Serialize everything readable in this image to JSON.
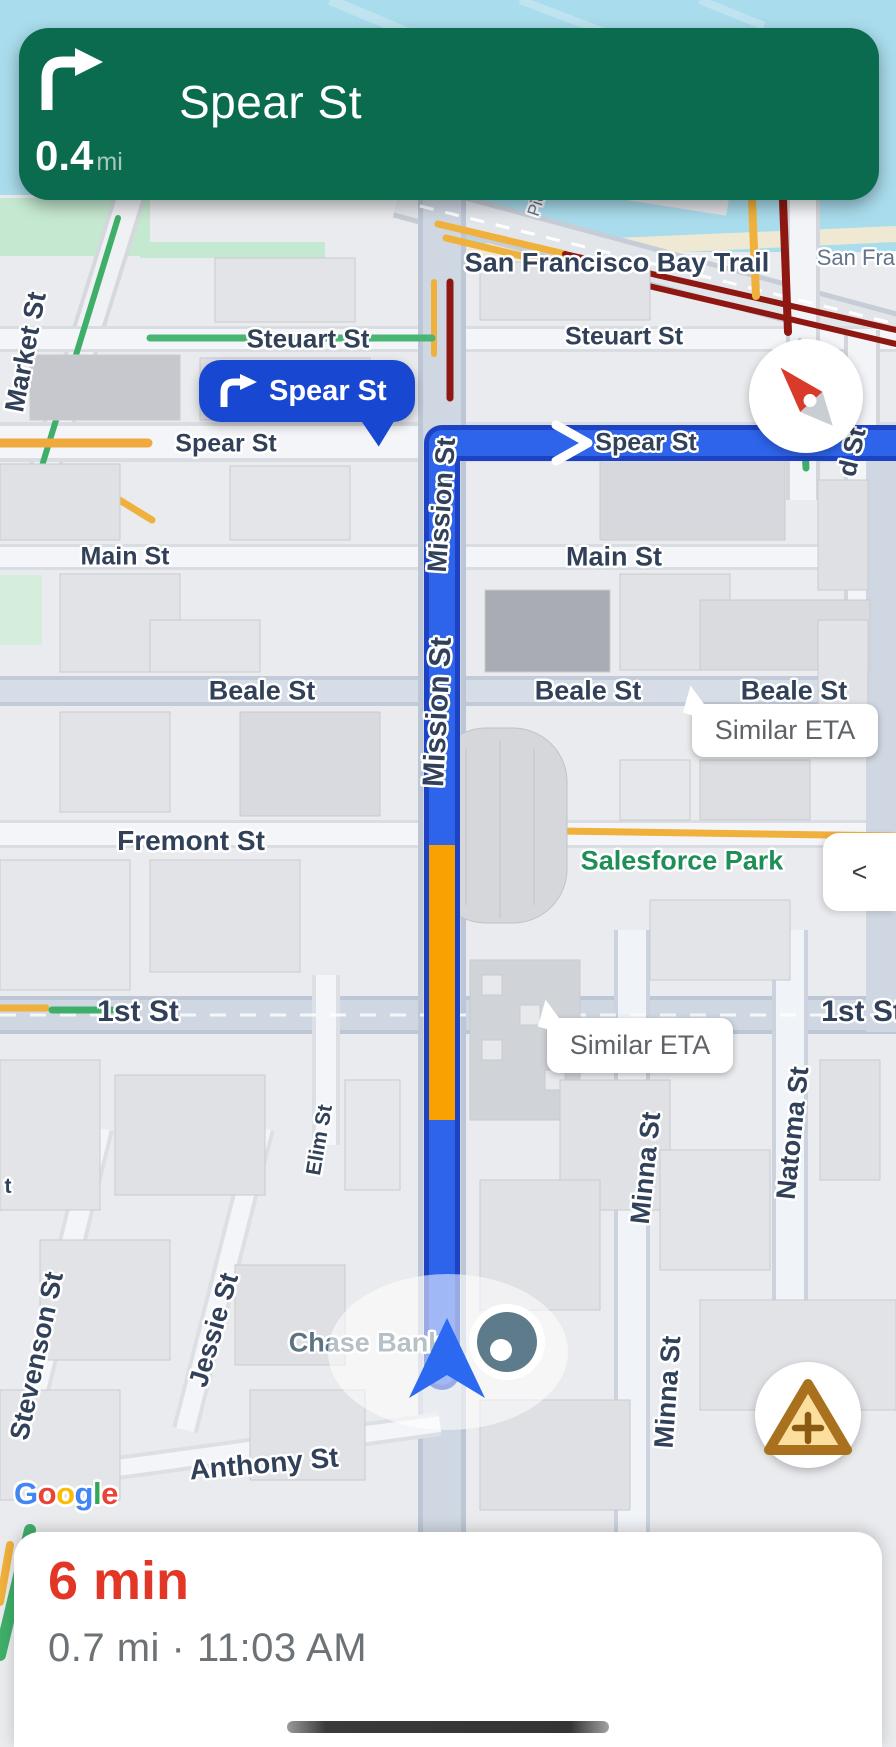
{
  "app": "maps-navigation",
  "navigation_banner": {
    "maneuver_icon": "turn-right-arrow",
    "distance": "0.4",
    "distance_unit": "mi",
    "instruction": "Spear St"
  },
  "turn_callout": {
    "icon": "turn-right-arrow",
    "label": "Spear St"
  },
  "route": {
    "current_street": "Mission St",
    "next_street": "Spear St"
  },
  "eta_bubbles": [
    {
      "text": "Similar ETA"
    },
    {
      "text": "Similar ETA"
    }
  ],
  "map_controls": {
    "compass_icon": "compass-needle",
    "collapse_label": "<",
    "report_icon": "warning-triangle-plus"
  },
  "map_labels": {
    "bay_trail": "San Francisco Bay Trail",
    "san_fran_partial": "San Fran",
    "pier_partial": "Pie",
    "steuart_left": "Steuart St",
    "steuart_right": "Steuart St",
    "spear_left": "Spear St",
    "spear_right": "Spear St",
    "market": "Market St",
    "main_left": "Main St",
    "main_right": "Main St",
    "beale_left": "Beale St",
    "beale_center": "Beale St",
    "beale_right": "Beale St",
    "fremont": "Fremont St",
    "salesforce_park": "Salesforce Park",
    "first_left": "1st St",
    "first_right": "1st St",
    "second_partial": "d St",
    "natoma": "Natoma St",
    "minna_upper": "Minna St",
    "minna_lower": "Minna St",
    "elim": "Elim St",
    "mission_upper": "Mission St",
    "mission_lower": "Mission St",
    "stevenson": "Stevenson St",
    "jessie": "Jessie St",
    "street_partial": "t",
    "chase_bank": "Chase Bank",
    "anthony": "Anthony St"
  },
  "google_logo": {
    "text": "Google",
    "letters": [
      {
        "ch": "G",
        "color": "#4285F4"
      },
      {
        "ch": "o",
        "color": "#EA4335"
      },
      {
        "ch": "o",
        "color": "#FBBC05"
      },
      {
        "ch": "g",
        "color": "#4285F4"
      },
      {
        "ch": "l",
        "color": "#34A853"
      },
      {
        "ch": "e",
        "color": "#EA4335"
      }
    ]
  },
  "bottom_sheet": {
    "eta": "6 min",
    "details": "0.7 mi · 11:03 AM"
  },
  "colors": {
    "banner_green": "#0B6B4E",
    "callout_blue": "#1847D1",
    "route_blue": "#2E64EA",
    "route_casing": "#1D43C4",
    "congestion_orange": "#F9A100",
    "eta_red": "#E23726",
    "traffic_red": "#8F1711",
    "traffic_yellow": "#F0B03C",
    "traffic_green": "#3FAE68",
    "water_blue": "#A9DCEC"
  }
}
